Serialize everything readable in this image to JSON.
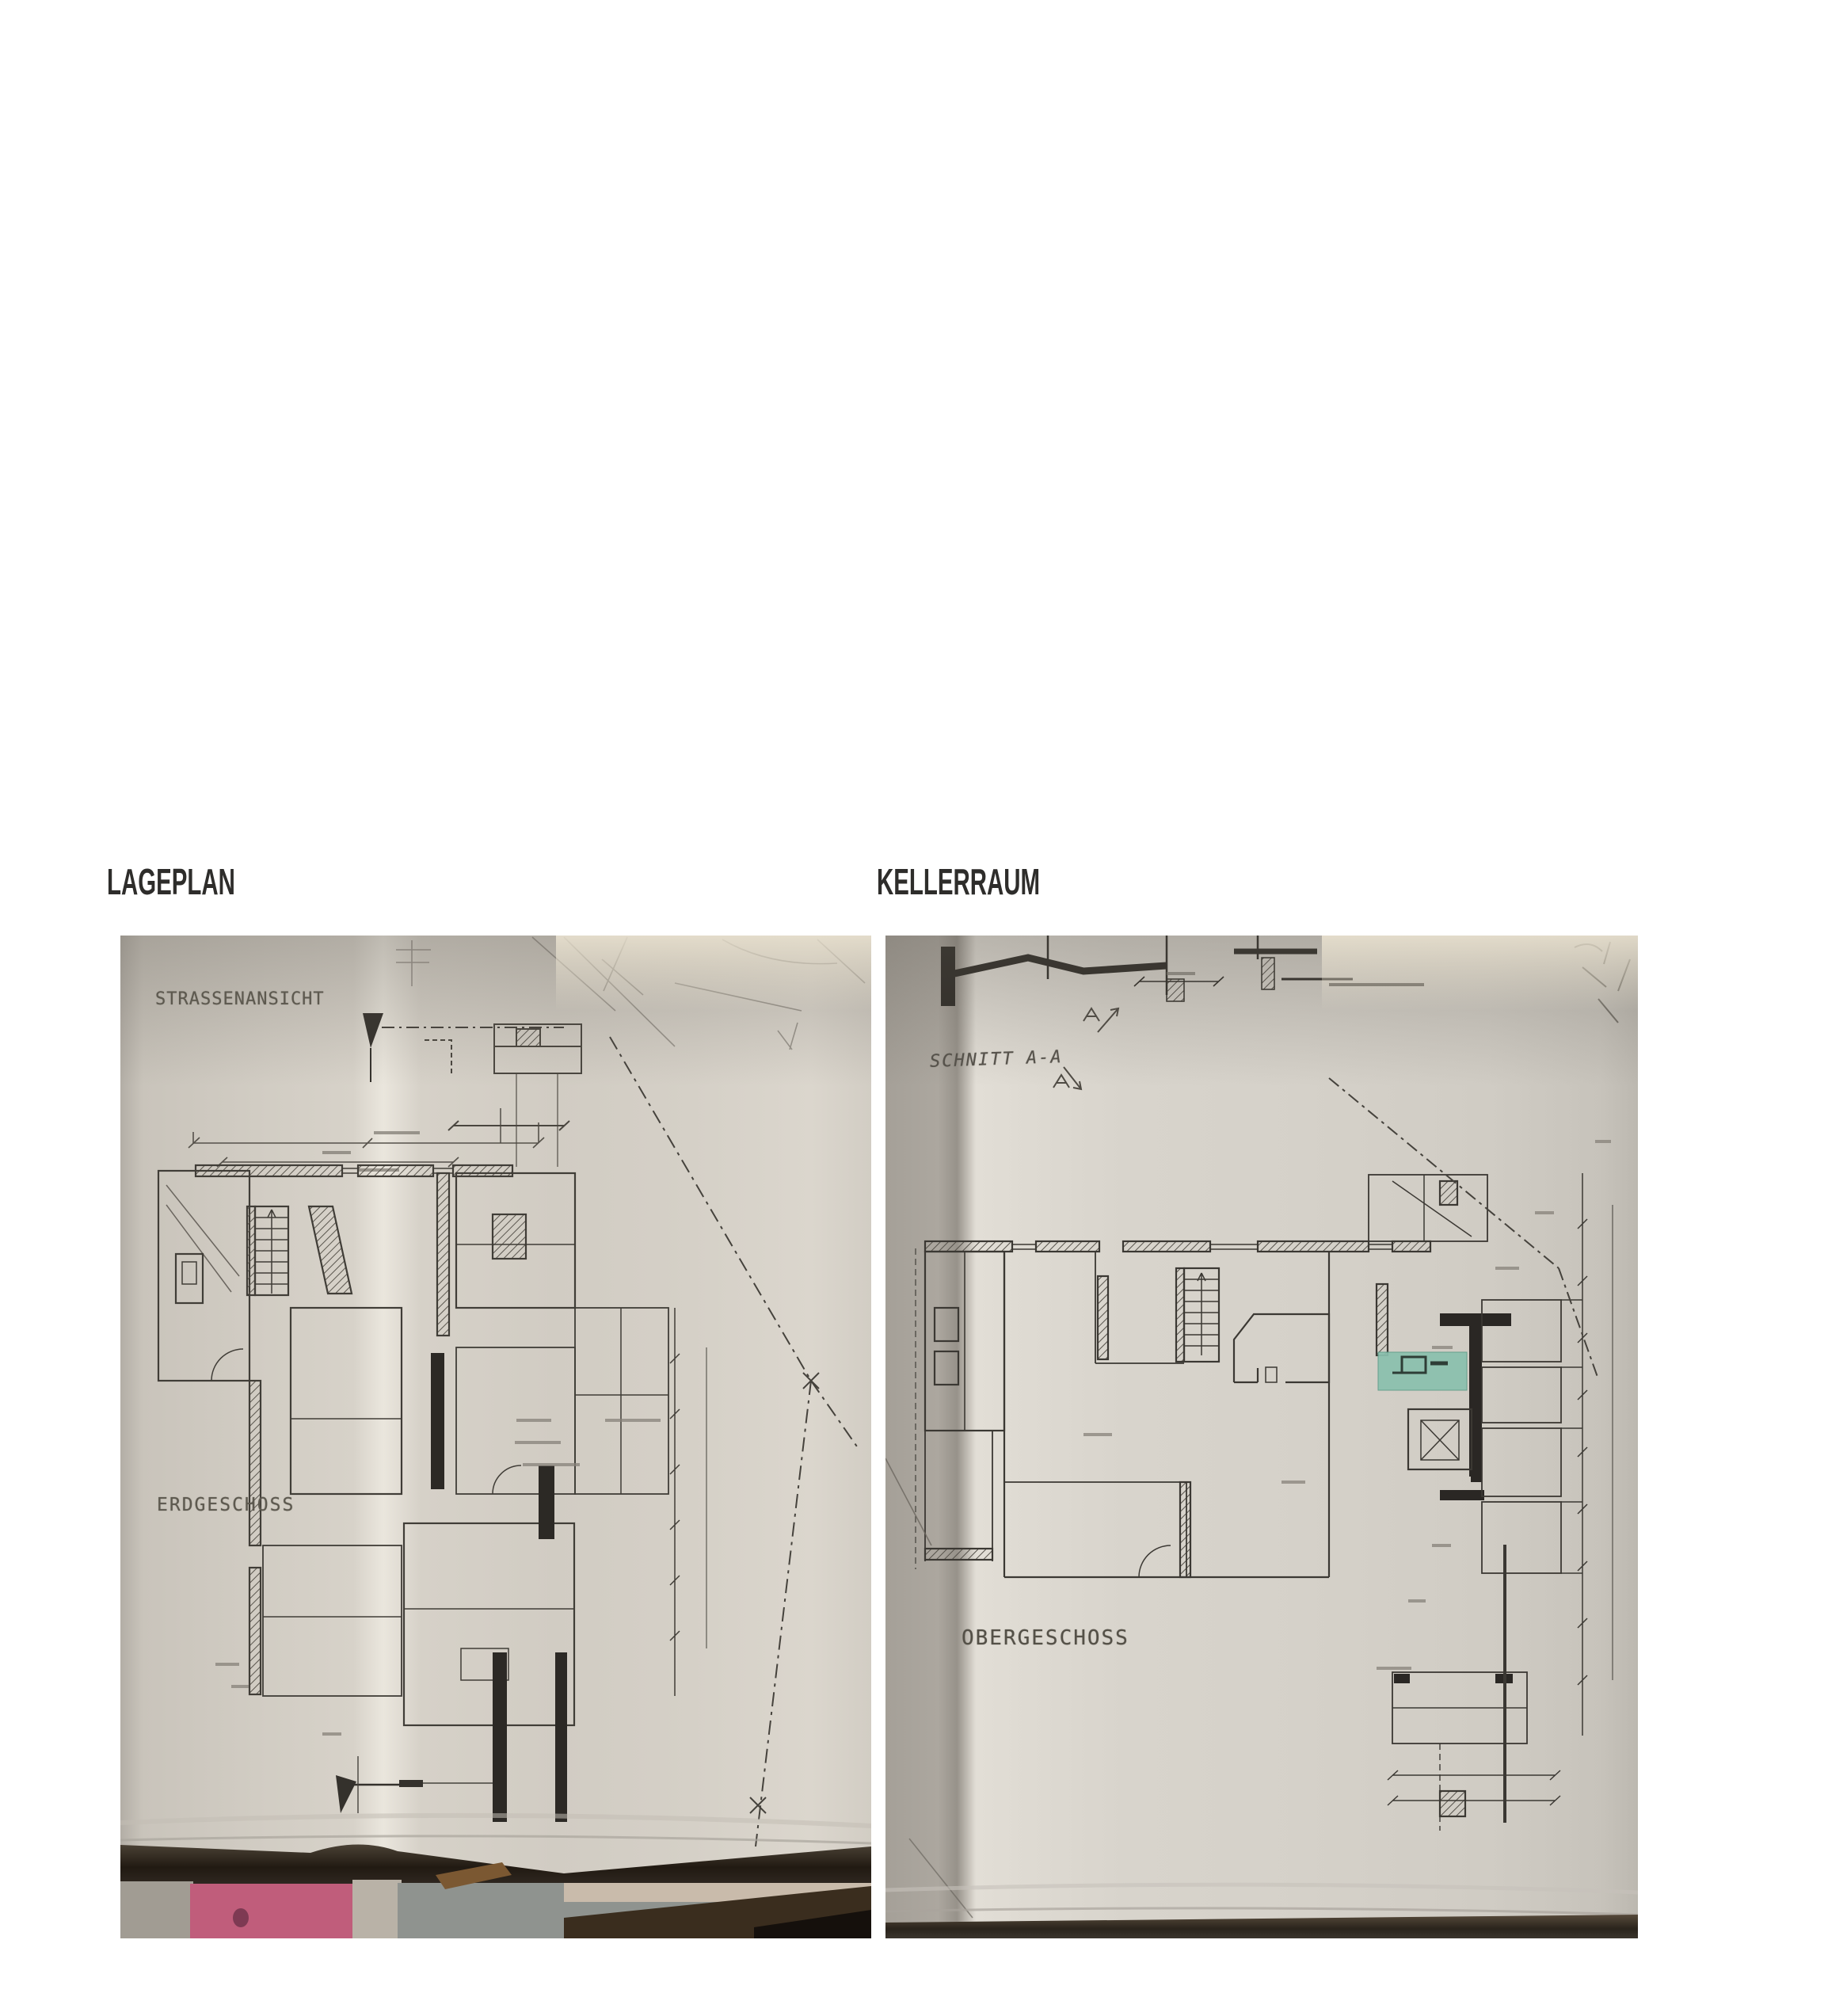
{
  "page": {
    "background": "#ffffff"
  },
  "figures": {
    "left": {
      "heading": "LAGEPLAN",
      "photo": {
        "description": "photo of folded site/ground-floor plan on a table",
        "labels": {
          "title": "STRASSENANSICHT",
          "floor": "ERDGESCHOSS"
        },
        "colors": {
          "paper": "#d6d1c8",
          "ink": "#403d37",
          "heavy_wall": "#2c2925",
          "table_shadow": "#221b13",
          "pink_object": "#c05d7b",
          "floor_gray": "#8f938f",
          "wood_object": "#7b5832"
        }
      }
    },
    "right": {
      "heading": "KELLERRAUM",
      "photo": {
        "description": "photo of folded basement/section plan with highlighted cellar room",
        "labels": {
          "title": "SCHNITT A-A",
          "floor": "OBERGESCHOSS"
        },
        "colors": {
          "paper": "#d5d1c9",
          "ink": "#3b3833",
          "heavy_wall": "#2a2724",
          "room_highlight": "#8ac0ae",
          "table_shadow": "#2a241c"
        }
      }
    }
  }
}
